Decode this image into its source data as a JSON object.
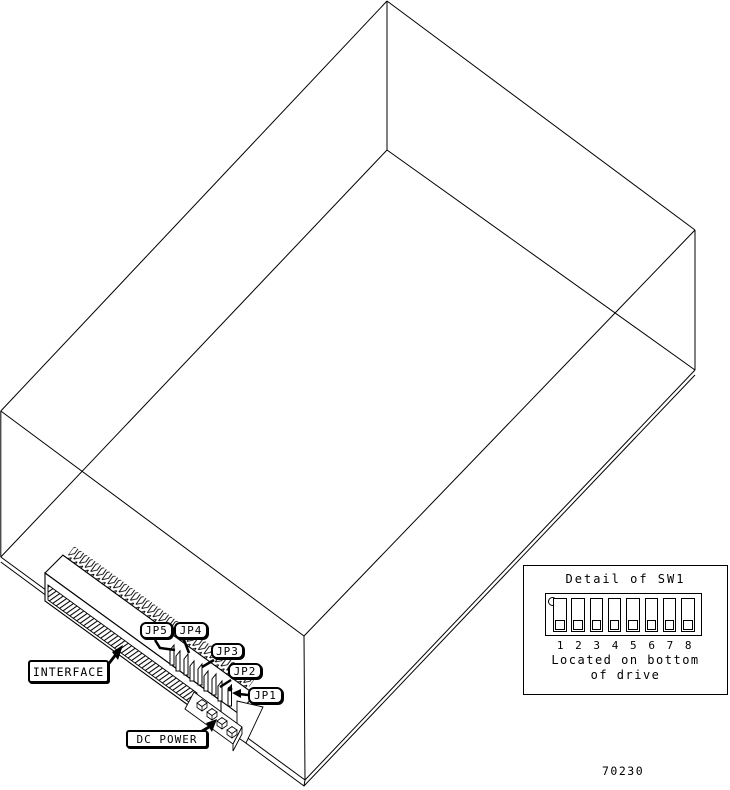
{
  "drawing": {
    "description": "Isometric wireframe line drawing of a disk drive with connector callouts",
    "colors": {
      "line": "#000000",
      "background": "#ffffff"
    }
  },
  "labels": {
    "interface": "INTERFACE",
    "jp5": "JP5",
    "jp4": "JP4",
    "jp3": "JP3",
    "jp2": "JP2",
    "jp1": "JP1",
    "dc_power": "DC POWER"
  },
  "detail": {
    "title": "Detail of SW1",
    "switch_numbers": [
      "1",
      "2",
      "3",
      "4",
      "5",
      "6",
      "7",
      "8"
    ],
    "note_line1": "Located on bottom",
    "note_line2": "of drive"
  },
  "page": {
    "number": "70230"
  }
}
